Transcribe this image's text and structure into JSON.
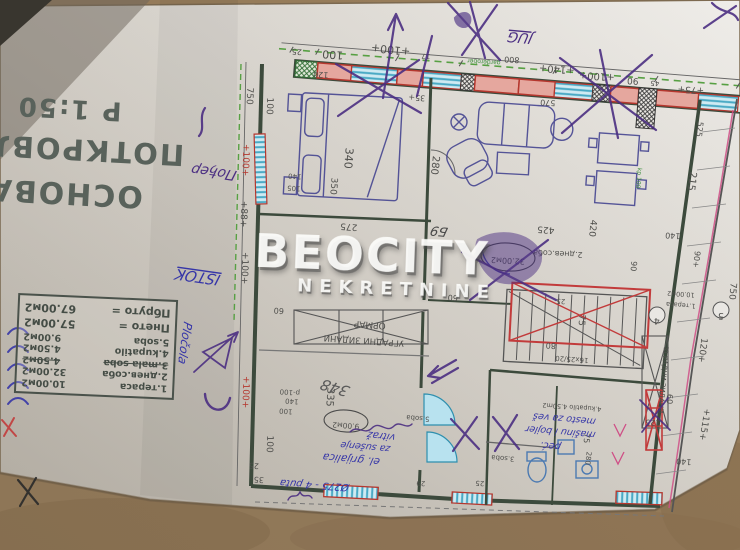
{
  "title_block": {
    "line1": "ОСНОВА",
    "line2": "ПОТКРОВЉА",
    "line3": "Р 1:50"
  },
  "legend_table": {
    "rows": [
      {
        "name": "1.тераса",
        "value": "10.00м2",
        "struck": false
      },
      {
        "name": "2.днев.соба",
        "value": "32.00м2",
        "struck": false
      },
      {
        "name": "3.mala soba",
        "value": "4.50м2",
        "struck": true
      },
      {
        "name": "4.kupatilo",
        "value": "4.50м2",
        "struck": false
      },
      {
        "name": "5.soba",
        "value": "9.00м2",
        "struck": false
      }
    ],
    "net_label": "Пнето =",
    "net_value": "57.00м2",
    "gross_label": "Пбруто =",
    "gross_value": "67.00м2"
  },
  "watermark": {
    "brand": "BEOCITY",
    "subtitle": "NEKRETNINE"
  },
  "colors": {
    "cardboard": "#9a7f5c",
    "paper": "#e6e3dd",
    "wall": "#3c4a3c",
    "red": "#b5372e",
    "cyan": "#2e8fae",
    "green_dash": "#57a043",
    "ink_purple": "#4b2e82",
    "ink_blue": "#3636a8",
    "pink": "#cf4f86"
  },
  "labels": [
    {
      "t": "25",
      "x": 297,
      "y": 49,
      "r": 184,
      "s": 8
    },
    {
      "t": "100",
      "x": 333,
      "y": 51,
      "r": 184,
      "s": 11
    },
    {
      "t": "+100+",
      "x": 391,
      "y": 46,
      "r": 186,
      "s": 11
    },
    {
      "t": "17",
      "x": 426,
      "y": 54,
      "r": 184,
      "s": 7
    },
    {
      "t": "800",
      "x": 512,
      "y": 57,
      "r": 184,
      "s": 8
    },
    {
      "t": "+140+",
      "x": 557,
      "y": 66,
      "r": 184,
      "s": 10
    },
    {
      "t": "+100+",
      "x": 597,
      "y": 73,
      "r": 184,
      "s": 10
    },
    {
      "t": "90",
      "x": 633,
      "y": 78,
      "r": 184,
      "s": 9
    },
    {
      "t": "45",
      "x": 655,
      "y": 81,
      "r": 184,
      "s": 7
    },
    {
      "t": "+75+",
      "x": 691,
      "y": 87,
      "r": 184,
      "s": 9
    },
    {
      "t": "750",
      "x": 247,
      "y": 96,
      "r": 92,
      "s": 9
    },
    {
      "t": "+100+",
      "x": 243,
      "y": 160,
      "r": 92,
      "s": 9,
      "c": "#b5372e"
    },
    {
      "t": "+88+",
      "x": 241,
      "y": 214,
      "r": 92,
      "s": 9
    },
    {
      "t": "+100+",
      "x": 242,
      "y": 268,
      "r": 92,
      "s": 9
    },
    {
      "t": "+100+",
      "x": 243,
      "y": 392,
      "r": 92,
      "s": 9,
      "c": "#b5372e"
    },
    {
      "t": "25",
      "x": 254,
      "y": 463,
      "r": 184,
      "s": 8
    },
    {
      "t": "35",
      "x": 259,
      "y": 477,
      "r": 184,
      "s": 8
    },
    {
      "t": "100",
      "x": 267,
      "y": 106,
      "r": 92,
      "s": 9
    },
    {
      "t": "525",
      "x": 697,
      "y": 129,
      "r": 97,
      "s": 8
    },
    {
      "t": "215",
      "x": 689,
      "y": 181,
      "r": 97,
      "s": 10
    },
    {
      "t": "90+",
      "x": 694,
      "y": 259,
      "r": 97,
      "s": 8
    },
    {
      "t": "750",
      "x": 730,
      "y": 291,
      "r": 95,
      "s": 9
    },
    {
      "t": "120+",
      "x": 700,
      "y": 350,
      "r": 97,
      "s": 9
    },
    {
      "t": "+115+",
      "x": 702,
      "y": 424,
      "r": 99,
      "s": 9
    },
    {
      "t": "140",
      "x": 673,
      "y": 233,
      "r": 184,
      "s": 8
    },
    {
      "t": "140",
      "x": 684,
      "y": 459,
      "r": 184,
      "s": 8
    },
    {
      "t": "125",
      "x": 653,
      "y": 420,
      "r": 184,
      "s": 8
    },
    {
      "t": "60",
      "x": 667,
      "y": 399,
      "r": 92,
      "s": 8
    },
    {
      "t": "90",
      "x": 631,
      "y": 266,
      "r": 95,
      "s": 8
    },
    {
      "t": "120",
      "x": 321,
      "y": 72,
      "r": 184,
      "s": 8
    },
    {
      "t": "570",
      "x": 548,
      "y": 100,
      "r": 184,
      "s": 8
    },
    {
      "t": "35+",
      "x": 417,
      "y": 95,
      "r": 184,
      "s": 8
    },
    {
      "t": "340",
      "x": 345,
      "y": 158,
      "r": 94,
      "s": 11
    },
    {
      "t": "350",
      "x": 331,
      "y": 186,
      "r": 94,
      "s": 9
    },
    {
      "t": "140",
      "x": 295,
      "y": 174,
      "r": 184,
      "s": 7
    },
    {
      "t": "105",
      "x": 294,
      "y": 186,
      "r": 184,
      "s": 7
    },
    {
      "t": "275",
      "x": 349,
      "y": 224,
      "r": 184,
      "s": 9
    },
    {
      "t": "425",
      "x": 546,
      "y": 227,
      "r": 184,
      "s": 9
    },
    {
      "t": "420",
      "x": 590,
      "y": 228,
      "r": 96,
      "s": 9
    },
    {
      "t": "280",
      "x": 432,
      "y": 165,
      "r": 96,
      "s": 10
    },
    {
      "t": "60",
      "x": 279,
      "y": 308,
      "r": 184,
      "s": 8
    },
    {
      "t": "60",
      "x": 453,
      "y": 295,
      "r": 184,
      "s": 8
    },
    {
      "t": "335",
      "x": 327,
      "y": 397,
      "r": 94,
      "s": 10
    },
    {
      "t": "p-100",
      "x": 290,
      "y": 390,
      "r": 184,
      "s": 7
    },
    {
      "t": "140",
      "x": 292,
      "y": 399,
      "r": 184,
      "s": 7
    },
    {
      "t": "100",
      "x": 286,
      "y": 409,
      "r": 184,
      "s": 7
    },
    {
      "t": "100",
      "x": 267,
      "y": 444,
      "r": 92,
      "s": 9
    },
    {
      "t": "75",
      "x": 579,
      "y": 320,
      "r": 94,
      "s": 9
    },
    {
      "t": "80",
      "x": 551,
      "y": 343,
      "r": 184,
      "s": 8
    },
    {
      "t": "16x25/20",
      "x": 572,
      "y": 357,
      "r": 184,
      "s": 7
    },
    {
      "t": "280",
      "x": 586,
      "y": 458,
      "r": 96,
      "s": 7
    },
    {
      "t": "75",
      "x": 584,
      "y": 438,
      "r": 94,
      "s": 8
    },
    {
      "t": "25",
      "x": 480,
      "y": 481,
      "r": 184,
      "s": 7
    },
    {
      "t": "29",
      "x": 421,
      "y": 481,
      "r": 184,
      "s": 7
    },
    {
      "t": "25",
      "x": 561,
      "y": 299,
      "r": 184,
      "s": 7
    },
    {
      "t": "2.днев.соба",
      "x": 558,
      "y": 251,
      "r": 183,
      "s": 8
    },
    {
      "t": "32.00м2",
      "x": 508,
      "y": 258,
      "r": 183,
      "s": 8
    },
    {
      "t": "5.soba",
      "x": 418,
      "y": 416,
      "r": 184,
      "s": 7
    },
    {
      "t": "9.00м2",
      "x": 346,
      "y": 423,
      "r": 184,
      "s": 7.5
    },
    {
      "t": "4.kupatilo 4.50m2",
      "x": 572,
      "y": 405,
      "r": 184,
      "s": 6.5
    },
    {
      "t": "3.soba",
      "x": 503,
      "y": 456,
      "r": 184,
      "s": 7
    },
    {
      "t": "1.тераса",
      "x": 681,
      "y": 303,
      "r": 184,
      "s": 6.5
    },
    {
      "t": "10.00м2",
      "x": 681,
      "y": 292,
      "r": 184,
      "s": 6.5
    },
    {
      "t": "ОРМАР",
      "x": 370,
      "y": 322,
      "r": 184,
      "s": 9
    },
    {
      "t": "УГРАДНИ ЗИДАНИ",
      "x": 364,
      "y": 338,
      "r": 184,
      "s": 8.5
    },
    {
      "t": "УГРАДНИ ЗИДАНИ",
      "x": 661,
      "y": 380,
      "r": 95,
      "s": 7
    },
    {
      "t": "garderober",
      "x": 484,
      "y": 60,
      "r": 184,
      "s": 6,
      "c": "#3f8f3f"
    },
    {
      "t": "kp 100",
      "x": 637,
      "y": 178,
      "r": 95,
      "s": 6,
      "c": "#3f8f3f"
    },
    {
      "t": "Пођер",
      "x": 215,
      "y": 168,
      "r": 188,
      "s": 14,
      "c": "#4b2e82",
      "f": "hand"
    },
    {
      "t": "ISTOK",
      "x": 199,
      "y": 272,
      "r": 188,
      "s": 15,
      "c": "#3636a8",
      "f": "hand",
      "u": true
    },
    {
      "t": "Pločola",
      "x": 181,
      "y": 342,
      "r": 98,
      "s": 12,
      "c": "#3636a8",
      "f": "hand"
    },
    {
      "t": "JUG",
      "x": 521,
      "y": 33,
      "r": 185,
      "s": 14,
      "c": "#4b2e82",
      "f": "hand",
      "u": true
    },
    {
      "t": "Б9",
      "x": 440,
      "y": 227,
      "r": 186,
      "s": 13,
      "c": "#4a4a4a",
      "f": "hand"
    },
    {
      "t": "348",
      "x": 337,
      "y": 383,
      "r": 196,
      "s": 15,
      "c": "#5a5a5a",
      "f": "hand"
    },
    {
      "t": "vitraž",
      "x": 382,
      "y": 433,
      "r": 186,
      "s": 10,
      "c": "#3636a8",
      "f": "hand"
    },
    {
      "t": "za sušenje",
      "x": 366,
      "y": 444,
      "r": 185,
      "s": 9.5,
      "c": "#3636a8",
      "f": "hand"
    },
    {
      "t": "el. grijalica",
      "x": 352,
      "y": 456,
      "r": 185,
      "s": 10.5,
      "c": "#3636a8",
      "f": "hand"
    },
    {
      "t": "Ø275 - 4 puta",
      "x": 315,
      "y": 482,
      "r": 184,
      "s": 10,
      "c": "#3636a8",
      "f": "hand"
    },
    {
      "t": "mesto za veš",
      "x": 565,
      "y": 416,
      "r": 185,
      "s": 9.5,
      "c": "#3636a8",
      "f": "hand"
    },
    {
      "t": "mašinu i bojler",
      "x": 561,
      "y": 429,
      "r": 185,
      "s": 9.5,
      "c": "#3636a8",
      "f": "hand"
    },
    {
      "t": "peć.",
      "x": 551,
      "y": 443,
      "r": 185,
      "s": 10,
      "c": "#3636a8",
      "f": "hand"
    }
  ],
  "room_ellipses": [
    {
      "cx": 508,
      "cy": 257,
      "rx": 27,
      "ry": 14,
      "r": 4
    },
    {
      "cx": 346,
      "cy": 421,
      "rx": 22,
      "ry": 11,
      "r": 4
    }
  ],
  "axis_bubbles": [
    {
      "t": "4",
      "x": 657,
      "y": 315
    },
    {
      "t": "5",
      "x": 721,
      "y": 310
    }
  ]
}
